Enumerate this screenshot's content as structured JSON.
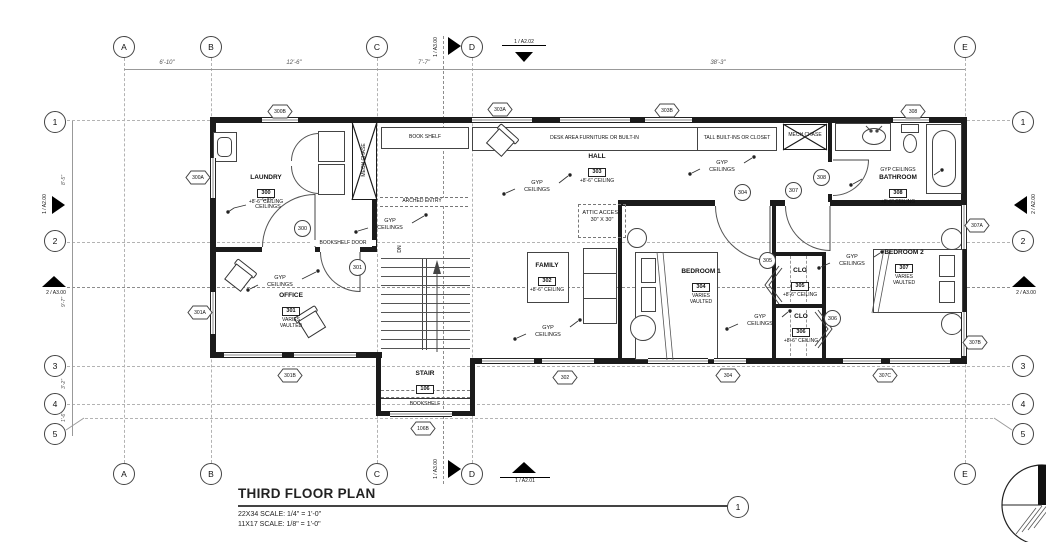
{
  "sheet": {
    "title": "THIRD FLOOR PLAN",
    "scale_22x34": "22X34 SCALE: 1/4\" = 1'-0\"",
    "scale_11x17": "11X17 SCALE: 1/8\" = 1'-0\"",
    "detail_number": "1"
  },
  "grid": {
    "cols": [
      {
        "label": "A"
      },
      {
        "label": "B"
      },
      {
        "label": "C"
      },
      {
        "label": "D"
      },
      {
        "label": "E"
      }
    ],
    "rows": [
      {
        "label": "1"
      },
      {
        "label": "2"
      },
      {
        "label": "3"
      },
      {
        "label": "4"
      },
      {
        "label": "5"
      }
    ],
    "dims_top": [
      {
        "text": "6'-10\""
      },
      {
        "text": "12'-6\""
      },
      {
        "text": "7'-7\""
      },
      {
        "text": "38'-3\""
      }
    ],
    "dims_left": [
      {
        "text": "8'-5\""
      },
      {
        "text": "9'-7\""
      },
      {
        "text": "3'-2\""
      },
      {
        "text": "1'-6\""
      }
    ]
  },
  "markers": {
    "top_a300": "1 / A3.00",
    "top_a202": "1 / A2.02",
    "left_a200": "1 / A2.00",
    "left_a300": "2 / A3.00",
    "right_a200": "2 / A2.00",
    "right_a300": "2 / A3.00",
    "bottom_a300": "1 / A3.00",
    "bottom_a201": "1 / A2.01"
  },
  "rooms": {
    "laundry": {
      "name": "LAUNDRY",
      "number": "300",
      "note": "+8'-6\" CEILING"
    },
    "office": {
      "name": "OFFICE",
      "number": "301",
      "note1": "VARIES",
      "note2": "VAULTED"
    },
    "family": {
      "name": "FAMILY",
      "number": "302",
      "note": "+8'-6\" CEILING"
    },
    "hall": {
      "name": "HALL",
      "number": "303",
      "note": "+8'-6\" CEILING"
    },
    "bedroom1": {
      "name": "BEDROOM 1",
      "number": "304",
      "note1": "VARIES",
      "note2": "VAULTED"
    },
    "clo305": {
      "name": "CLO",
      "number": "305",
      "note": "+8'-6\" CEILING"
    },
    "clo306": {
      "name": "CLO",
      "number": "306",
      "note": "+8'-6\" CEILING"
    },
    "bedroom2": {
      "name": "BEDROOM 2",
      "number": "307",
      "note1": "VARIES",
      "note2": "VAULTED"
    },
    "bathroom": {
      "pre": "GYP CEILINGS",
      "name": "BATHROOM",
      "number": "308",
      "note": "+8'-6\" CEILING"
    },
    "stair": {
      "name": "STAIR",
      "number": "106"
    }
  },
  "labels": {
    "book_shelf": "BOOK SHELF",
    "desk_area": "DESK AREA FURNITURE OR BUILT-IN",
    "tall_builtins": "TALL BUILT-INS OR CLOSET",
    "mech_chase": "MECH CHASE",
    "arched_entry": "ARCHED ENTRY",
    "bookshelf_door": "BOOKSHELF DOOR",
    "attic_access": "ATTIC ACCESS",
    "attic_size": "30\" X 30\"",
    "bookshelf": "BOOKSHELF",
    "dn": "DN",
    "gyp": "GYP",
    "ceilings": "CEILINGS"
  },
  "door_tags": {
    "300": "300",
    "301": "301",
    "304": "304",
    "305": "305",
    "306": "306",
    "307": "307",
    "308": "308"
  },
  "window_tags": {
    "300A": "300A",
    "300B": "300B",
    "301A": "301A",
    "301B": "301B",
    "302": "302",
    "303A": "303A",
    "303B": "303B",
    "304": "304",
    "106B": "106B",
    "307A": "307A",
    "307B": "307B",
    "307C": "307C",
    "308": "308"
  }
}
